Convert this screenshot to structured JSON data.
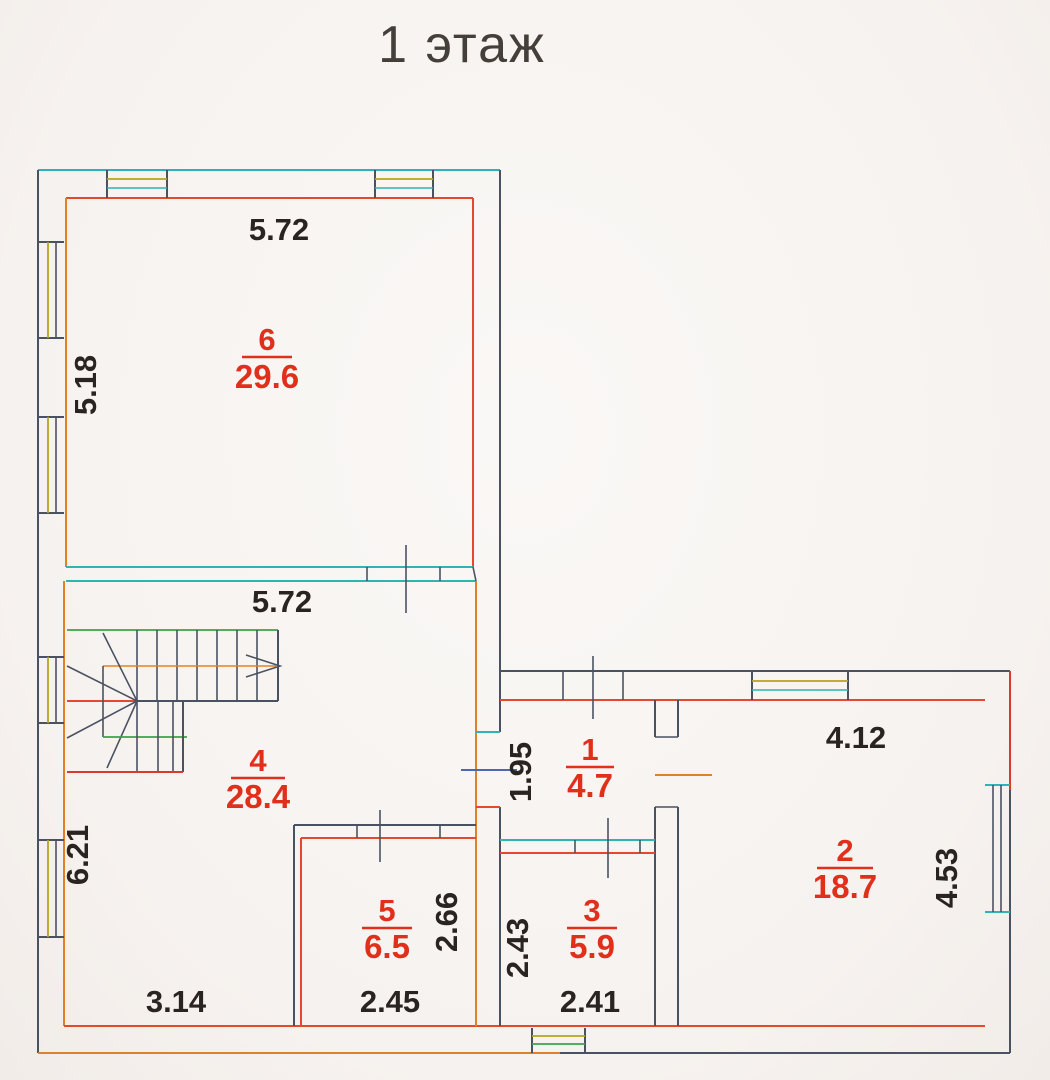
{
  "title": "1 этаж",
  "rooms": {
    "room1": {
      "number": "1",
      "area": "4.7"
    },
    "room2": {
      "number": "2",
      "area": "18.7"
    },
    "room3": {
      "number": "3",
      "area": "5.9"
    },
    "room4": {
      "number": "4",
      "area": "28.4"
    },
    "room5": {
      "number": "5",
      "area": "6.5"
    },
    "room6": {
      "number": "6",
      "area": "29.6"
    }
  },
  "dimensions": {
    "room6_top_width": "5.72",
    "room6_left_height": "5.18",
    "hall_top_width": "5.72",
    "room1_width": "1.95",
    "room2_top_width": "4.12",
    "hall_left_height": "6.21",
    "room5_right_height": "2.66",
    "room3_left_height": "2.43",
    "room2_right_height": "4.53",
    "hall_bottom_width": "3.14",
    "room5_bottom_width": "2.45",
    "room3_bottom_width": "2.41"
  },
  "colors": {
    "paper": "#f7f4f1",
    "wall_primary": "#4a5262",
    "wall_red": "#e34a2d",
    "wall_orange": "#e08125",
    "wall_teal": "#2fb3b3",
    "window_yellow": "#b5a41f",
    "room_label_red": "#e0301c",
    "dimension_text": "#2a2420"
  }
}
